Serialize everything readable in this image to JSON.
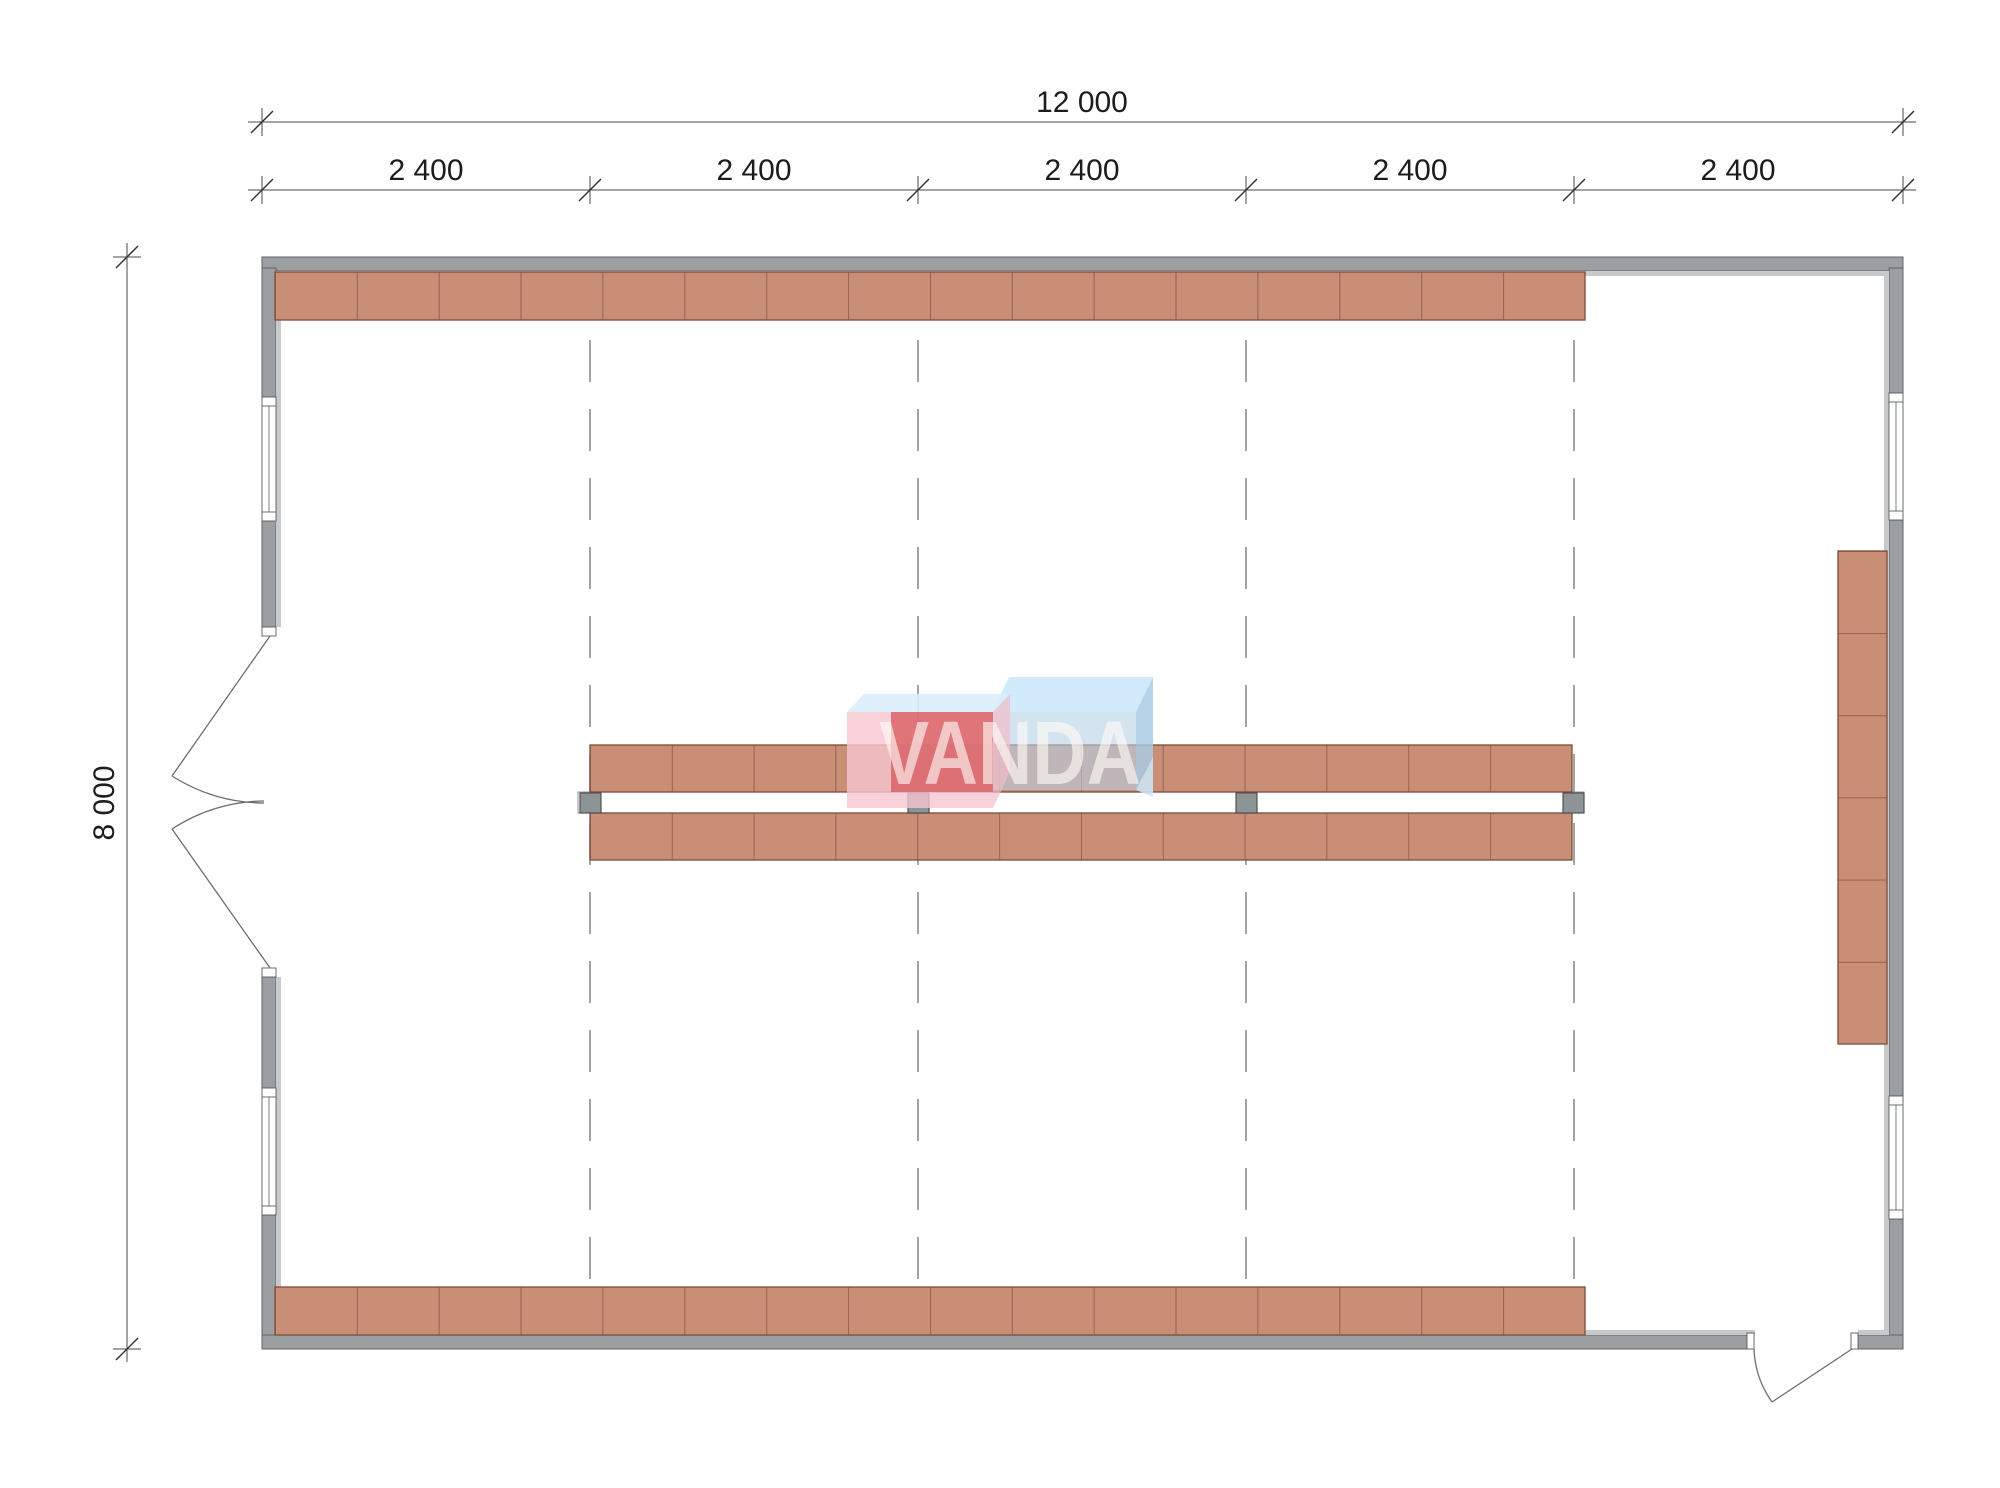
{
  "meta": {
    "drawing_type": "storage building floor plan",
    "watermark": "VANDA"
  },
  "dims": {
    "total_width": "12 000",
    "total_height": "8 000",
    "bay_labels": [
      "2 400",
      "2 400",
      "2 400",
      "2 400",
      "2 400"
    ]
  },
  "plan": {
    "building_mm": {
      "width": 12000,
      "height": 8000,
      "bay": 2400,
      "bays": 5
    },
    "shelving": {
      "top_row_units": 16,
      "bottom_row_units": 16,
      "center_top_row_units": 12,
      "center_bottom_row_units": 12,
      "right_wall_column_units": 6
    },
    "structure": {
      "grid_columns": 4,
      "windows": 4,
      "doors": [
        {
          "wall": "left",
          "type": "double-swing"
        },
        {
          "wall": "bottom-right",
          "type": "single-swing"
        }
      ]
    },
    "colors": {
      "wall": "#9c9fa1",
      "wall_lining": "#c6cacc",
      "shelf_fill": "#c88e76",
      "shelf_border": "#7e4b3b",
      "grid_line": "#7d7d7d",
      "dim_line": "#4a4a4a",
      "column": "#8e9395",
      "logo_pink": "#f6c5cf",
      "logo_red": "#d95f64",
      "logo_blue_top": "#cde9f9",
      "logo_blue_front": "#b7d1e6"
    }
  }
}
